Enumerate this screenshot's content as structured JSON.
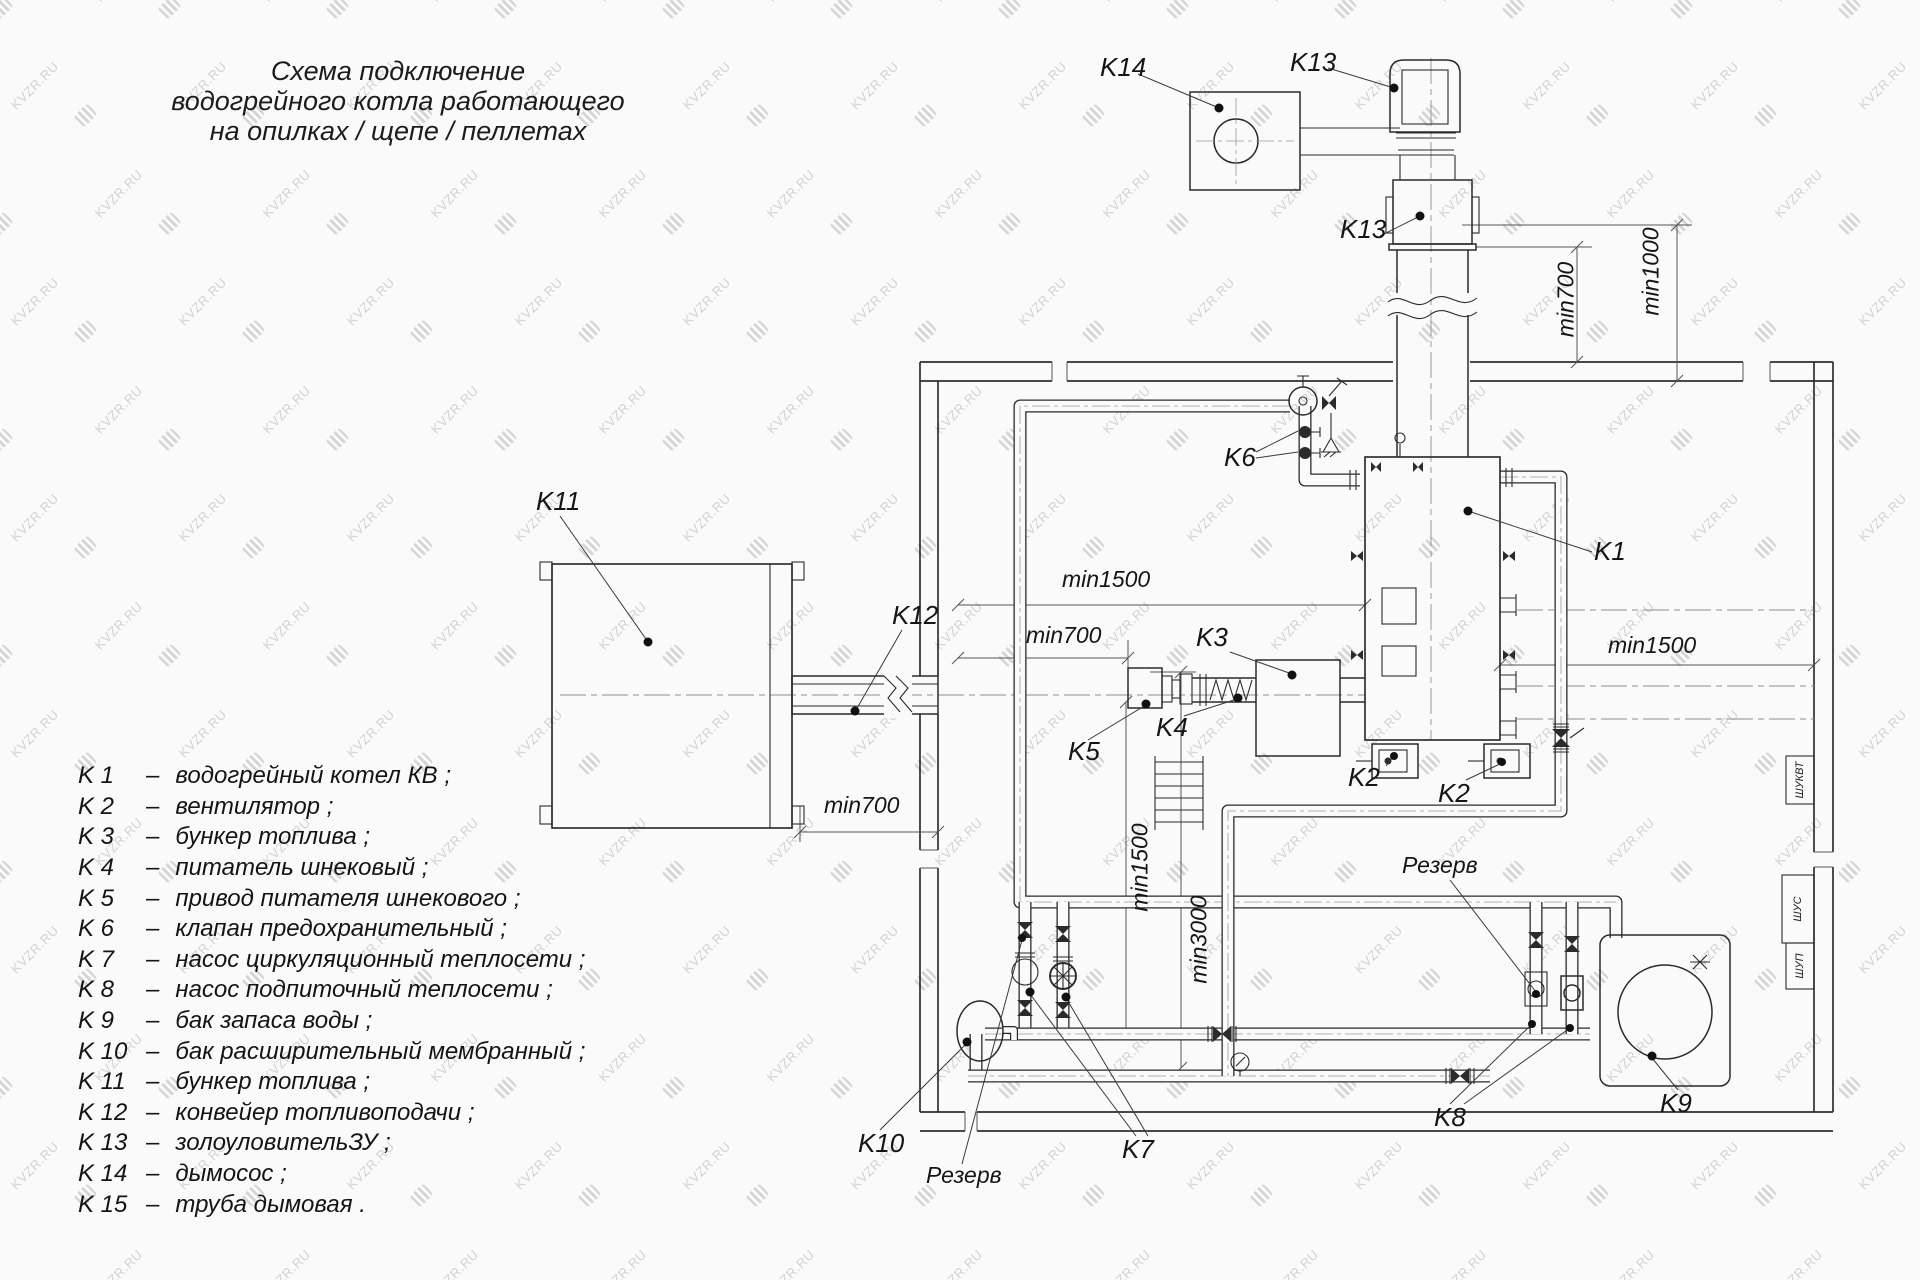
{
  "watermark": {
    "text": "KVZR.RU"
  },
  "title": {
    "line1": "Схема подключение",
    "line2": "водогрейного котла работающего",
    "line3": "на опилках / щепе / пеллетах"
  },
  "legend": {
    "separator": "–",
    "items": [
      {
        "code": "K 1",
        "desc": "водогрейный котел КВ ;"
      },
      {
        "code": "K 2",
        "desc": "вентилятор ;"
      },
      {
        "code": "K 3",
        "desc": "бункер топлива ;"
      },
      {
        "code": "K 4",
        "desc": "питатель шнековый ;"
      },
      {
        "code": "K 5",
        "desc": "привод питателя шнекового ;"
      },
      {
        "code": "K 6",
        "desc": "клапан предохранительный ;"
      },
      {
        "code": "K 7",
        "desc": "насос циркуляционный теплосети ;"
      },
      {
        "code": "K 8",
        "desc": "насос подпиточный теплосети ;"
      },
      {
        "code": "K 9",
        "desc": "бак запаса воды ;"
      },
      {
        "code": "K 10",
        "desc": "бак расширительный мембранный ;"
      },
      {
        "code": "K 11",
        "desc": "бункер топлива ;"
      },
      {
        "code": "K 12",
        "desc": "конвейер топливоподачи ;"
      },
      {
        "code": "K 13",
        "desc": "золоуловительЗУ ;"
      },
      {
        "code": "K 14",
        "desc": "дымосос ;"
      },
      {
        "code": "K 15",
        "desc": "труба дымовая ."
      }
    ]
  },
  "labels": {
    "k1": "K1",
    "k2_left": "K2",
    "k2_right": "K2",
    "k3": "K3",
    "k4": "K4",
    "k5": "K5",
    "k6": "K6",
    "k7": "K7",
    "k8": "K8",
    "k9": "K9",
    "k10": "K10",
    "k11": "K11",
    "k12": "K12",
    "k13_top": "K13",
    "k13_mid": "K13",
    "k14": "K14",
    "reserve_left": "Резерв",
    "reserve_right": "Резерв"
  },
  "dimensions": {
    "right_min700": "min700",
    "right_min1000": "min1000",
    "right_min1500": "min1500",
    "center_min1500": "min1500",
    "center_min700": "min700",
    "left_min700": "min700",
    "vertical_min1500": "min1500",
    "vertical_min3000": "min3000"
  },
  "cabinets": {
    "top": "ШУКВТ",
    "middle": "ШУС",
    "bottom": "ШУП"
  }
}
